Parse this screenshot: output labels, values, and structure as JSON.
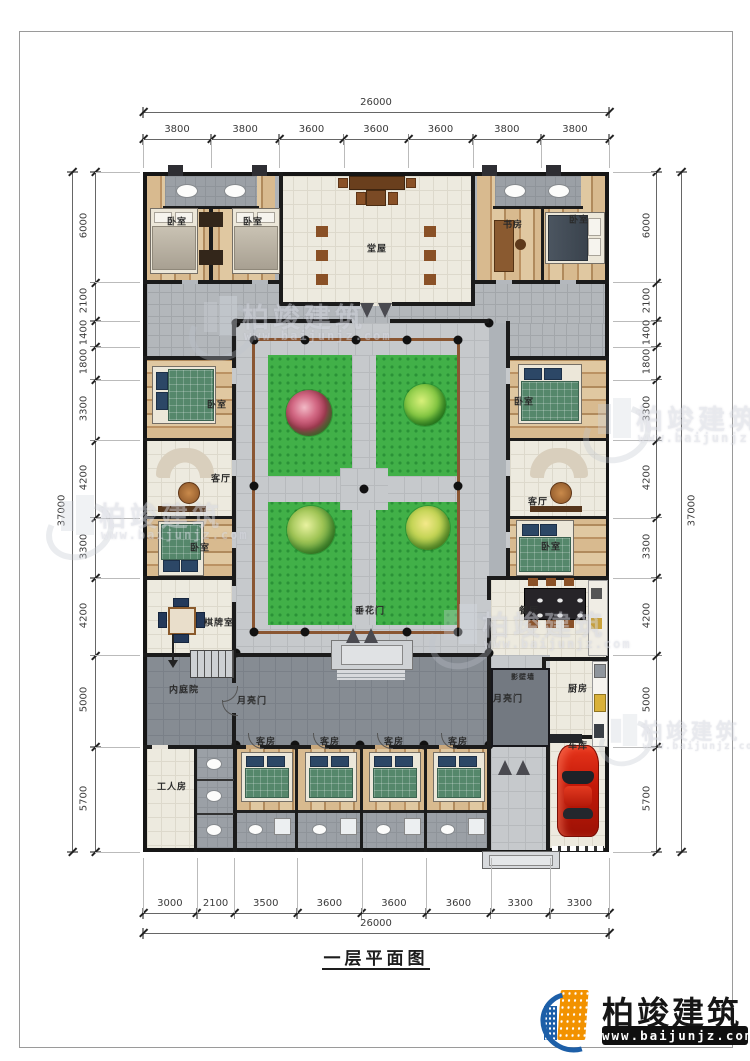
{
  "title": {
    "text": "一层平面图"
  },
  "logo": {
    "brand": "柏竣建筑",
    "website": "www.baijunjz.com"
  },
  "watermark": {
    "brand": "柏竣建筑",
    "website": "www.baijunjz.com"
  },
  "dimensions": {
    "top": {
      "total": 26000,
      "segments": [
        3800,
        3800,
        3600,
        3600,
        3600,
        3800,
        3800
      ]
    },
    "bottom": {
      "total": 26000,
      "segments": [
        3000,
        2100,
        3500,
        3600,
        3600,
        3600,
        3300,
        3300
      ]
    },
    "left": {
      "total": 37000,
      "segments": [
        6000,
        2100,
        1400,
        1800,
        3300,
        4200,
        3300,
        4200,
        5000,
        5700
      ]
    },
    "right": {
      "total": 37000,
      "segments": [
        6000,
        2100,
        1400,
        1800,
        3300,
        4200,
        3300,
        4200,
        5000,
        5700
      ]
    }
  },
  "rooms": {
    "bedroom_tl1": "卧室",
    "bedroom_tl2": "卧室",
    "hall": "堂屋",
    "study": "书房",
    "bedroom_tr": "卧室",
    "bedroom_lw1": "卧室",
    "living_lw": "客厅",
    "bedroom_lw2": "卧室",
    "chess_room": "棋牌室",
    "bedroom_rw1": "卧室",
    "living_rw": "客厅",
    "bedroom_rw2": "卧室",
    "dining": "餐厅",
    "festoon_gate": "垂花门",
    "inner_courtyard": "内庭院",
    "moon_gate_left": "月亮门",
    "moon_gate_right": "月亮门",
    "screen_wall": "影壁墙",
    "kitchen": "厨房",
    "garage": "车库",
    "worker_room": "工人房",
    "guest1": "客房",
    "guest2": "客房",
    "guest3": "客房",
    "guest4": "客房"
  },
  "colors": {
    "wall": "#1b1b1b",
    "lawn_green": "#41b048",
    "pergola_brown": "#8a5632",
    "car_red": "#c21808",
    "logo_orange": "#f29200",
    "logo_blue": "#1d5fa8"
  }
}
